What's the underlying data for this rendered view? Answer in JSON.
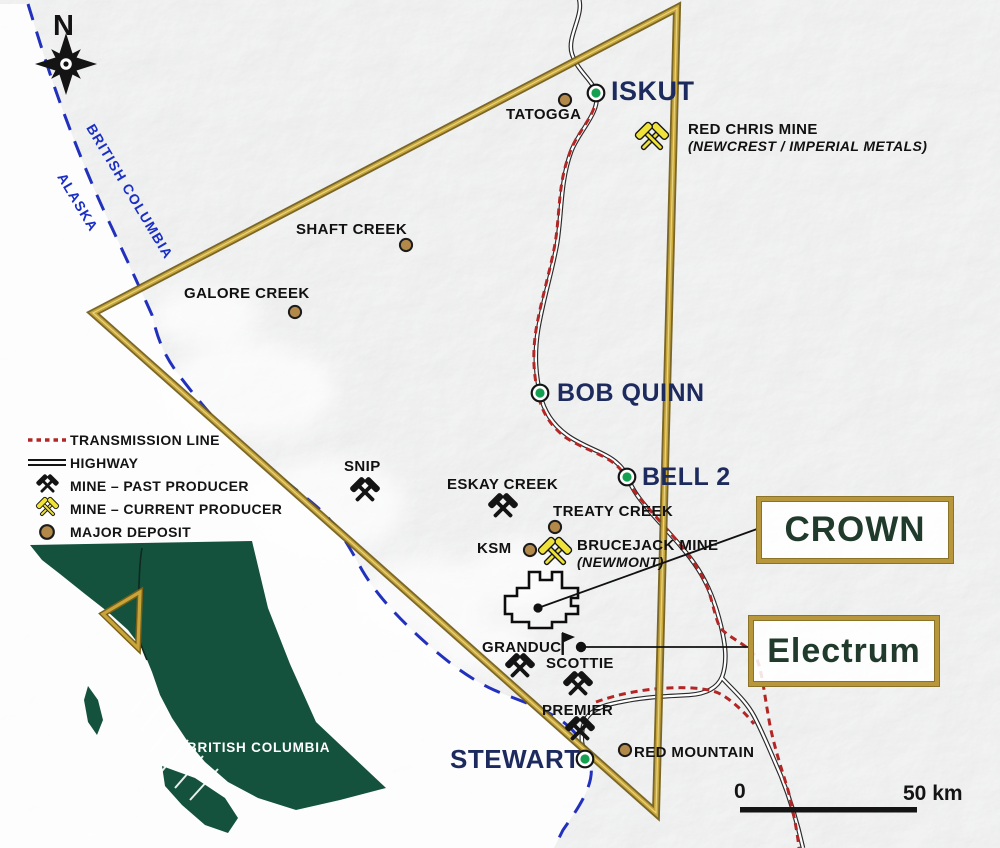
{
  "compass": {
    "north_label": "N"
  },
  "border": {
    "labels": [
      "BRITISH COLUMBIA",
      "ALASKA"
    ]
  },
  "towns": [
    {
      "name": "ISKUT"
    },
    {
      "name": "BOB QUINN"
    },
    {
      "name": "BELL 2"
    },
    {
      "name": "STEWART"
    }
  ],
  "deposits": [
    {
      "name": "TATOGGA"
    },
    {
      "name": "SHAFT CREEK"
    },
    {
      "name": "GALORE CREEK"
    },
    {
      "name": "TREATY CREEK"
    },
    {
      "name": "KSM"
    },
    {
      "name": "RED MOUNTAIN"
    }
  ],
  "past_producer_mines": [
    {
      "name": "SNIP"
    },
    {
      "name": "ESKAY CREEK"
    },
    {
      "name": "GRANDUC"
    },
    {
      "name": "SCOTTIE"
    },
    {
      "name": "PREMIER"
    }
  ],
  "current_producer_mines": [
    {
      "name": "RED CHRIS MINE",
      "owner": "(NEWCREST / IMPERIAL METALS)"
    },
    {
      "name": "BRUCEJACK MINE",
      "owner": "(NEWMONT)"
    }
  ],
  "properties": [
    {
      "name": "CROWN"
    },
    {
      "name": "Electrum"
    }
  ],
  "legend": {
    "items": [
      {
        "label": "TRANSMISSION LINE",
        "symbol": "transmission-line"
      },
      {
        "label": "HIGHWAY",
        "symbol": "highway"
      },
      {
        "label": "MINE – PAST PRODUCER",
        "symbol": "mine-past-producer"
      },
      {
        "label": "MINE – CURRENT PRODUCER",
        "symbol": "mine-current-producer"
      },
      {
        "label": "MAJOR DEPOSIT",
        "symbol": "major-deposit"
      }
    ]
  },
  "inset": {
    "label": "BRITISH COLUMBIA"
  },
  "scale_bar": {
    "start_label": "0",
    "end_label": "50 km"
  },
  "colors": {
    "triangle_gold": "#c7a53b",
    "town_green": "#14a050",
    "deposit_brown": "#b3894a",
    "transmission_red": "#b22626",
    "border_blue": "#2231bd",
    "inset_green": "#14523e",
    "town_label_navy": "#1c2a5e",
    "property_text_green": "#203a2c"
  }
}
